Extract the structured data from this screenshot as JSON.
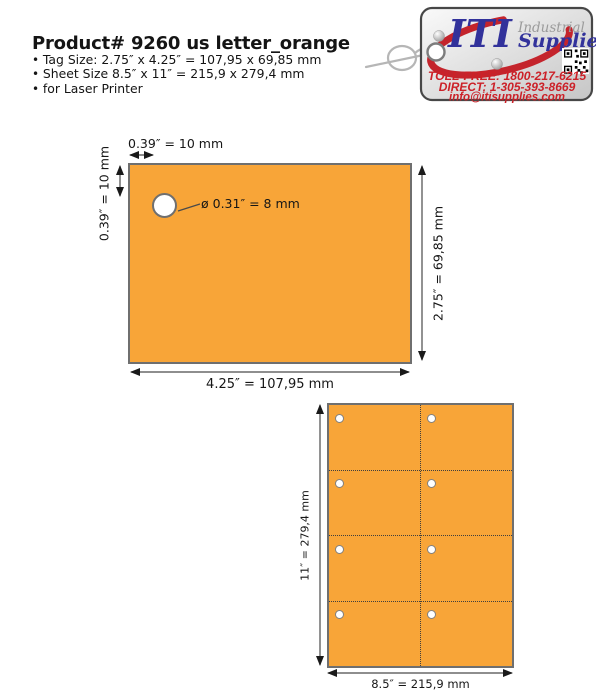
{
  "header": {
    "title": "Product# 9260 us letter_orange",
    "bullets": [
      "Tag Size: 2.75″ x 4.25″ = 107,95 x 69,85 mm",
      "Sheet Size 8.5″ x 11″ = 215,9 x 279,4 mm",
      "for Laser Printer"
    ]
  },
  "logo": {
    "brand": "ITI",
    "brand_line1": "Industrial",
    "brand_line2": "Supplies",
    "phone_tollfree": "TOLL-FREE: 1800-217-6215",
    "phone_direct": "DIRECT: 1-305-393-8669",
    "email": "info@itisupplies.com"
  },
  "tag_diagram": {
    "top_offset_label": "0.39″ = 10 mm",
    "left_offset_label": "0.39″ = 10 mm",
    "hole_label": "ø 0.31″ = 8 mm",
    "height_label": "2.75″ = 69,85 mm",
    "width_label": "4.25″ = 107,95 mm"
  },
  "sheet_diagram": {
    "height_label": "11″ = 279,4 mm",
    "width_label": "8.5″ = 215,9 mm",
    "columns": 2,
    "rows": 4
  },
  "colors": {
    "tag_orange": "#F8A538",
    "diagram_border": "#6F6F6F",
    "brand_blue": "#32329B",
    "brand_red": "#CC2128",
    "swoosh_red": "#C4242C"
  }
}
